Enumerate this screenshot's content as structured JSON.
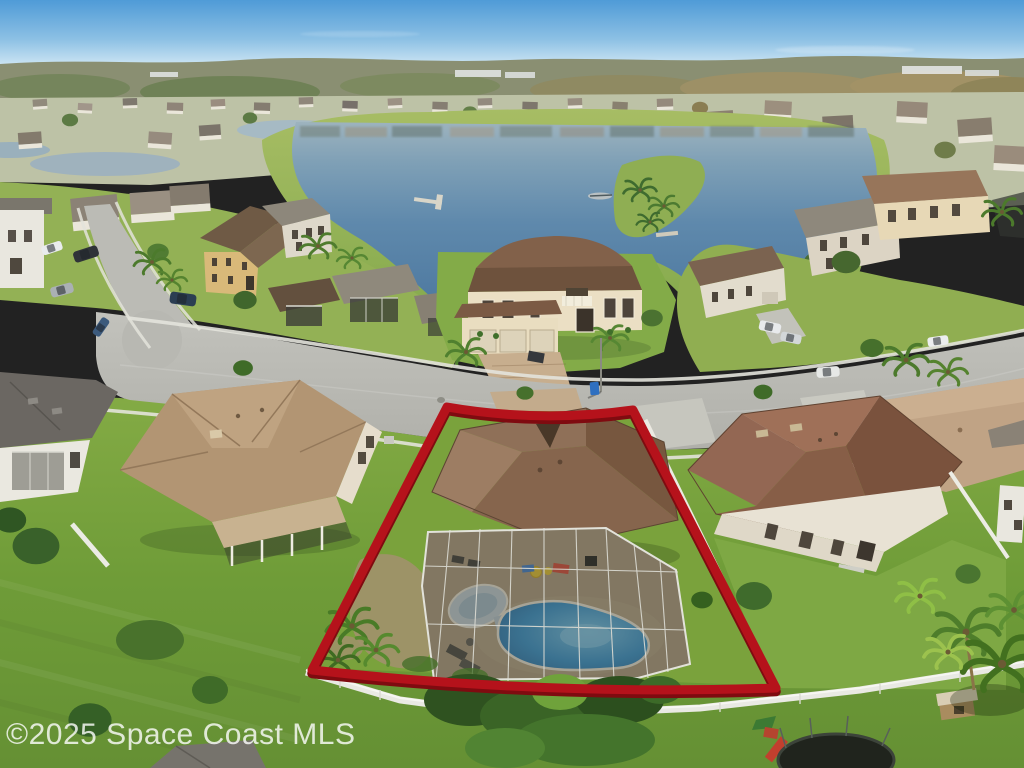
{
  "watermark": {
    "text": "©2025 Space Coast MLS"
  },
  "colors": {
    "outline_red": "#b5121b",
    "outline_red_shadow": "#7f0b10",
    "sky_top": "#4f9bd7",
    "lake_blue": "#5f89ac",
    "pool_blue": "#4698c9",
    "grass_green": "#7aa53e",
    "watermark_white": "rgba(255,255,255,0.80)"
  },
  "scene_labels": {
    "subject_property": "outlined-lot-with-screened-pool",
    "photo_type": "aerial-view"
  }
}
